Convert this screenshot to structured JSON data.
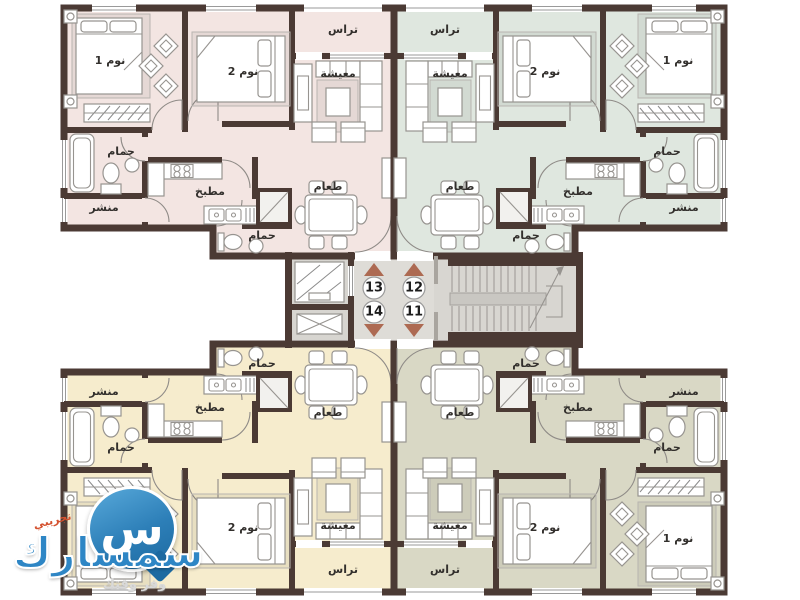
{
  "plan": {
    "room_labels": {
      "bedroom1": "نوم 1",
      "bedroom2": "نوم 2",
      "terrace": "تراس",
      "living": "معيشة",
      "dining": "طعام",
      "kitchen": "مطبخ",
      "bath": "حمام",
      "guest_bath": "حمام",
      "laundry": "منشر"
    },
    "units": [
      {
        "number": "13",
        "position": "top-left",
        "color": "#f3e5e2"
      },
      {
        "number": "12",
        "position": "top-right",
        "color": "#dfe7df"
      },
      {
        "number": "14",
        "position": "bottom-left",
        "color": "#f6eccd"
      },
      {
        "number": "11",
        "position": "bottom-right",
        "color": "#d9d8c5"
      }
    ],
    "core": {
      "up_unit_numbers": [
        "13",
        "12"
      ],
      "down_unit_numbers": [
        "14",
        "11"
      ],
      "arrow_color": "#ad6a52",
      "wall_color": "#4b3a34",
      "corridor_color": "#dcdad5"
    }
  },
  "watermark": {
    "brand": "سمسارك",
    "badge": "تجريبي",
    "tagline": "وفر وقتك",
    "icon_letter": "س",
    "brand_color": "#2e86c5"
  }
}
